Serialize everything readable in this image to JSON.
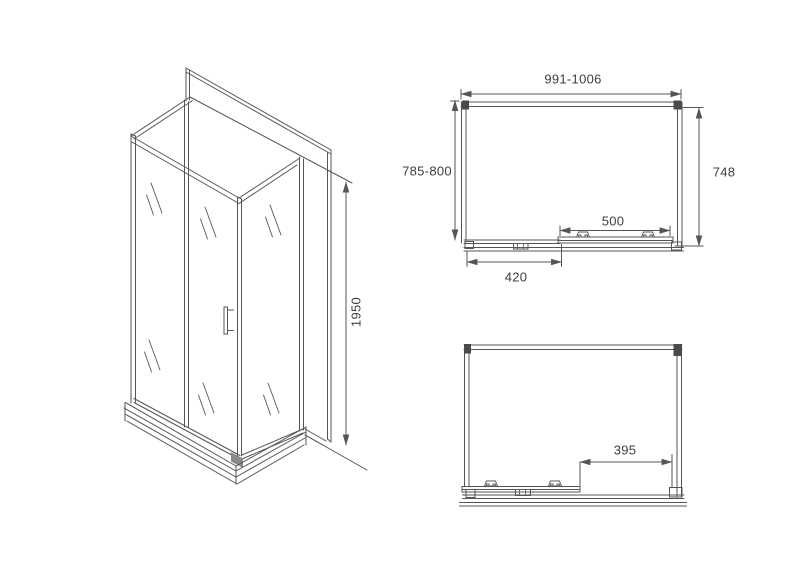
{
  "title": "Shower enclosure dimensional drawing",
  "dimensions": {
    "height": "1950",
    "width": "991-1006",
    "depth": "785-800",
    "side_depth": "748",
    "door_width": "500",
    "fixed_panel_width": "420",
    "door_opening": "395"
  },
  "colors": {
    "line": "#555555",
    "text": "#3d3d3d",
    "background": "#ffffff"
  }
}
